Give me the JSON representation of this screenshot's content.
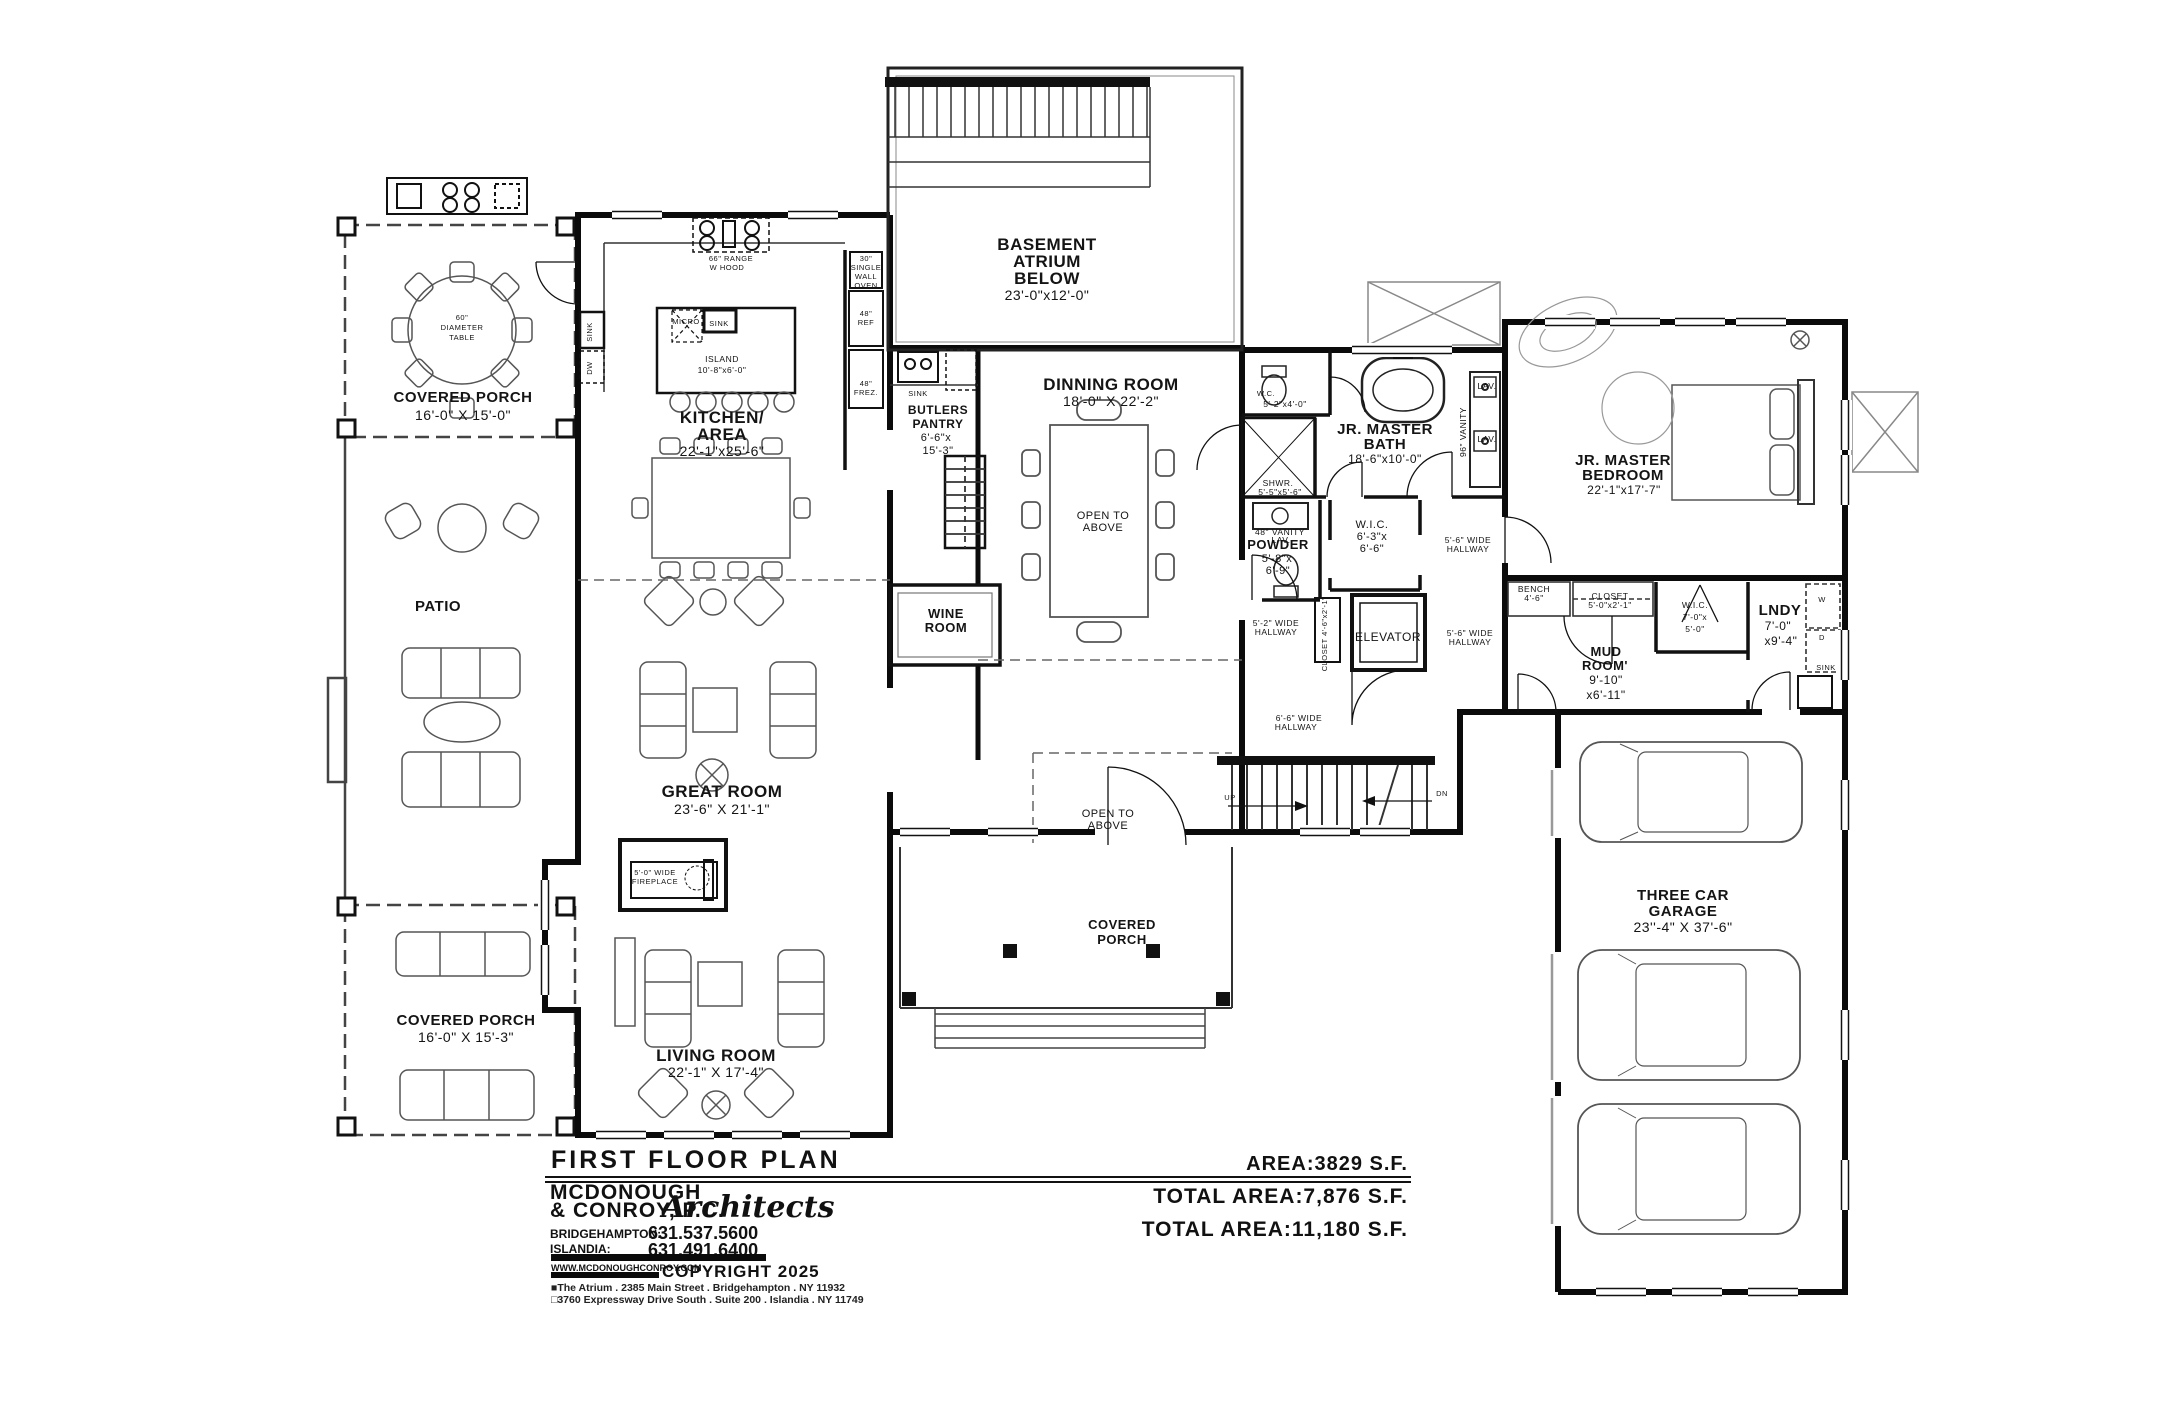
{
  "drawing": {
    "title": "FIRST FLOOR PLAN",
    "areas": {
      "first_floor": "AREA:3829 S.F.",
      "total_1": "TOTAL AREA:7,876 S.F.",
      "total_2": "TOTAL AREA:11,180 S.F."
    },
    "firm": {
      "name_line1": "MCDONOUGH",
      "name_line2": "& CONROY, P.C.",
      "name_script": "Architects",
      "office1_label": "BRIDGEHAMPTON:",
      "office1_phone": "631.537.5600",
      "office2_label": "ISLANDIA:",
      "office2_phone": "631.491.6400",
      "website": "WWW.MCDONOUGHCONROY.COM",
      "copyright": "COPYRIGHT 2025",
      "address1": "■The Atrium . 2385 Main Street . Bridgehampton . NY 11932",
      "address2": "□3760 Expressway Drive South . Suite 200 . Islandia . NY 11749"
    }
  },
  "rooms": {
    "porch_top": {
      "l1": "COVERED PORCH",
      "l2": "16'-0\" X 15'-0\""
    },
    "table60": {
      "l1": "60\"",
      "l2": "DIAMETER",
      "l3": "TABLE"
    },
    "patio": {
      "l1": "PATIO"
    },
    "porch_bottom": {
      "l1": "COVERED PORCH",
      "l2": "16'-0\" X 15'-3\""
    },
    "kitchen": {
      "l1": "KITCHEN/",
      "l2": "AREA",
      "l3": "22'-1\"x25'-6\""
    },
    "island": {
      "l1": "ISLAND",
      "l2": "10'-8\"x6'-0\""
    },
    "butlers": {
      "l1": "BUTLERS",
      "l2": "PANTRY",
      "l3": "6'-6\"x",
      "l4": "15'-3\""
    },
    "atrium": {
      "l1": "BASEMENT",
      "l2": "ATRIUM",
      "l3": "BELOW",
      "l4": "23'-0\"x12'-0\""
    },
    "dining": {
      "l1": "DINNING ROOM",
      "l2": "18'-0\" X 22'-2\""
    },
    "open_above": {
      "l1": "OPEN TO",
      "l2": "ABOVE"
    },
    "wine": {
      "l1": "WINE",
      "l2": "ROOM"
    },
    "great": {
      "l1": "GREAT ROOM",
      "l2": "23'-6\" X 21'-1\""
    },
    "fireplace": {
      "l1": "5'-0\" WIDE",
      "l2": "FIREPLACE"
    },
    "living": {
      "l1": "LIVING ROOM",
      "l2": "22'-1\" X 17'-4\""
    },
    "wc": {
      "l1": "W.C.",
      "l2": "5'-2\"x4'-0\""
    },
    "jr_bath": {
      "l1": "JR. MASTER",
      "l2": "BATH",
      "l3": "18'-6\"x10'-0\""
    },
    "shwr": {
      "l1": "SHWR.",
      "l2": "5'-5\"x5'-6\""
    },
    "vanity96": {
      "l1": "96\" VANITY"
    },
    "vanity48": {
      "l1": "48\" VANITY"
    },
    "powder": {
      "l1": "POWDER",
      "l2": "5'-8\"x",
      "l3": "6'-9\""
    },
    "wic_hall": {
      "l1": "W.I.C.",
      "l2": "6'-3\"x",
      "l3": "6'-6\""
    },
    "hall_52": {
      "l1": "5'-2\" WIDE",
      "l2": "HALLWAY"
    },
    "hall_56": {
      "l1": "5'-6\" WIDE",
      "l2": "HALLWAY"
    },
    "hall_66": {
      "l1": "6'-6\" WIDE",
      "l2": "HALLWAY"
    },
    "closet_hall": {
      "l1": "CLOSET 4'-6\"x2'-1\""
    },
    "elevator": {
      "l1": "ELEVATOR"
    },
    "bedroom": {
      "l1": "JR. MASTER",
      "l2": "BEDROOM",
      "l3": "22'-1\"x17'-7\""
    },
    "bench": {
      "l1": "BENCH",
      "l2": "4'-6\""
    },
    "closet_mud": {
      "l1": "CLOSET",
      "l2": "5'-0\"x2'-1\""
    },
    "wic_mud": {
      "l1": "W.I.C.",
      "l2": "7'-0\"x",
      "l3": "5'-0\""
    },
    "mud": {
      "l1": "MUD",
      "l2": "ROOM'",
      "l3": "9'-10\"",
      "l4": "x6'-11\""
    },
    "lndy": {
      "l1": "LNDY",
      "l2": "7'-0\"",
      "l3": "x9'-4\""
    },
    "garage": {
      "l1": "THREE CAR",
      "l2": "GARAGE",
      "l3": "23''-4\" X 37'-6\""
    },
    "porch_front": {
      "l1": "COVERED",
      "l2": "PORCH"
    }
  },
  "appliances": {
    "range": {
      "l1": "66\" RANGE",
      "l2": "W HOOD"
    },
    "oven": {
      "l1": "30\"",
      "l2": "SINGLE",
      "l3": "WALL",
      "l4": "OVEN"
    },
    "ref": {
      "l1": "48\"",
      "l2": "REF"
    },
    "frez": {
      "l1": "48\"",
      "l2": "FREZ."
    }
  },
  "fixtures": {
    "sink": "SINK",
    "dw": "DW",
    "micro": "MICRO",
    "lav": "LAV.",
    "washer": "W",
    "dryer": "D",
    "up": "UP",
    "dn": "DN"
  }
}
